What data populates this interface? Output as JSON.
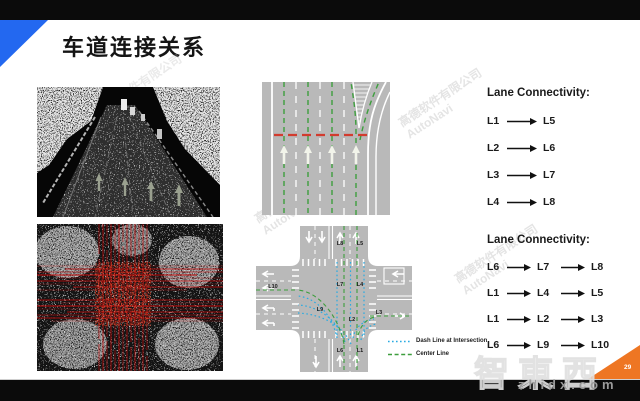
{
  "slide": {
    "title": "车道连接关系",
    "page_number": "29"
  },
  "colors": {
    "accent_blue": "#2368f0",
    "corner_orange": "#ee7623",
    "dash_line_blue": "#29abe2",
    "center_line_green": "#3d9e3d",
    "stop_line_red": "#d23b2e"
  },
  "watermarks": {
    "company_line1": "高德软件有限公司",
    "company_line2": "AutoNavi",
    "logo": "智東西",
    "site": "zhidx.com"
  },
  "lane_connectivity_top": {
    "heading": "Lane Connectivity:",
    "rows": [
      [
        "L1",
        "L5"
      ],
      [
        "L2",
        "L6"
      ],
      [
        "L3",
        "L7"
      ],
      [
        "L4",
        "L8"
      ]
    ]
  },
  "lane_connectivity_bottom": {
    "heading": "Lane Connectivity:",
    "rows": [
      [
        "L6",
        "L7",
        "L8"
      ],
      [
        "L1",
        "L4",
        "L5"
      ],
      [
        "L1",
        "L2",
        "L3"
      ],
      [
        "L6",
        "L9",
        "L10"
      ]
    ]
  },
  "intersection": {
    "labels": {
      "L1": "L1",
      "L2": "L2",
      "L3": "L3",
      "L4": "L4",
      "L5": "L5",
      "L6": "L6",
      "L7": "L7",
      "L8": "L8",
      "L9": "L9",
      "L10": "L10"
    },
    "legend": [
      {
        "label": "Dash Line at Intersection"
      },
      {
        "label": "Center Line"
      }
    ]
  }
}
